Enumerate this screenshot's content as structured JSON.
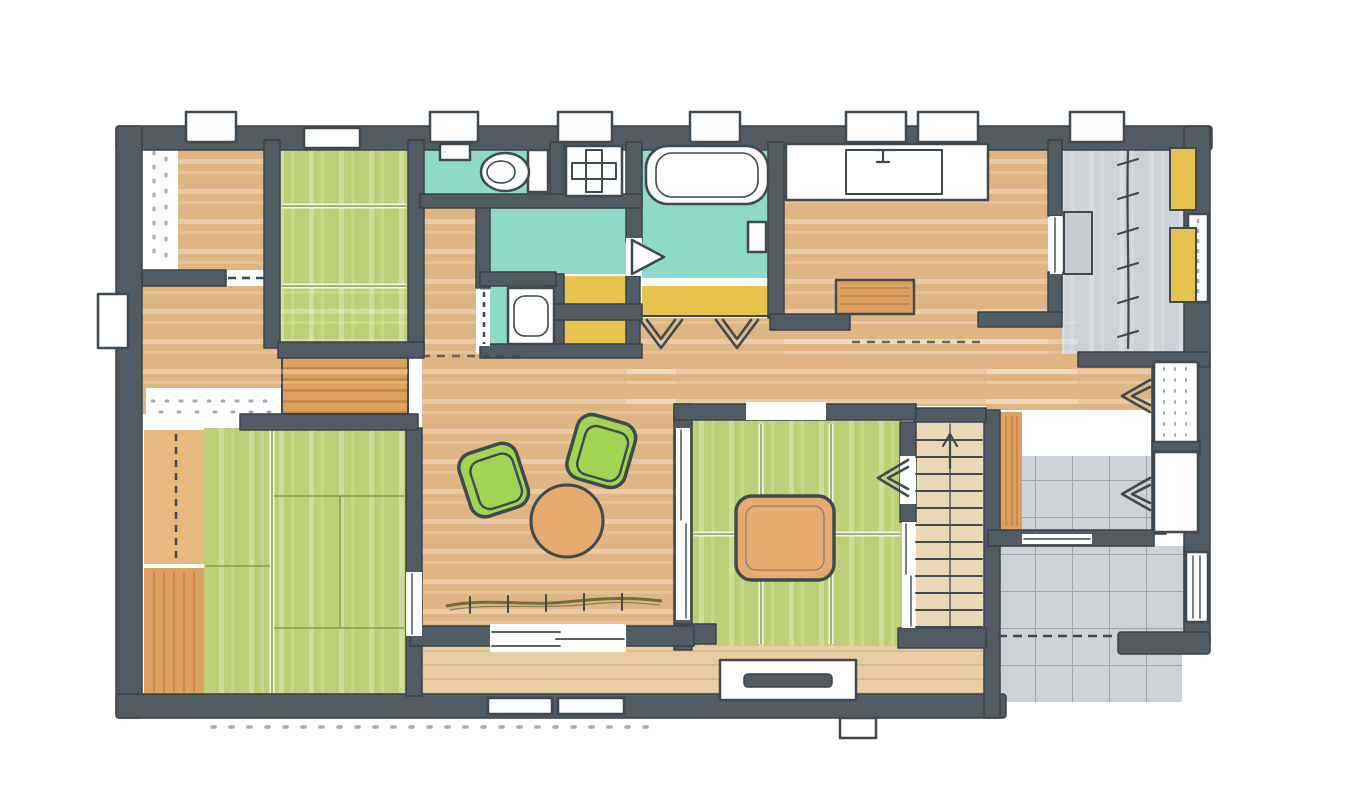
{
  "figure": {
    "label": "Hand-drawn marker sketch floor plan of a single-story Japanese house",
    "medium": "marker and ink sketch on white paper",
    "orientation": "landscape"
  },
  "palette": {
    "paper": "#ffffff",
    "wall": "#505b64",
    "wall_dark": "#39434c",
    "line": "#3e4950",
    "tan": "#dfb584",
    "tan_light": "#e9cda4",
    "wood": "#dda05d",
    "wood_light": "#e7b87e",
    "wood_dark": "#b97f42",
    "green": "#bed077",
    "green_line": "#8a9a50",
    "chair_green": "#a2d353",
    "teal": "#8edac5",
    "yellow": "#e6c24e",
    "tile": "#cdd2d6",
    "tile_line": "#9aa3a9",
    "orange": "#e6a96e",
    "olive": "#6e6f3e",
    "stair_floor": "#ead7b5"
  },
  "rooms": [
    {
      "id": "bedroom-northwest",
      "floor": "tan"
    },
    {
      "id": "bedroom-west",
      "floor": "tan"
    },
    {
      "id": "bedroom-southwest-tatami",
      "floor": "green"
    },
    {
      "id": "bedroom-north-green",
      "floor": "green"
    },
    {
      "id": "toilet-room",
      "floor": "teal"
    },
    {
      "id": "laundry-nook",
      "floor": "white"
    },
    {
      "id": "washroom-vanity",
      "floor": "teal"
    },
    {
      "id": "bathroom",
      "floor": "teal"
    },
    {
      "id": "kitchen",
      "floor": "tan"
    },
    {
      "id": "dining",
      "floor": "tan"
    },
    {
      "id": "living-room",
      "floor": "tan"
    },
    {
      "id": "tatami-room",
      "floor": "green"
    },
    {
      "id": "engawa-veranda",
      "floor": "tan-light"
    },
    {
      "id": "staircase",
      "floor": "stair-floor"
    },
    {
      "id": "east-hallway",
      "floor": "tan"
    },
    {
      "id": "walk-in-storage",
      "floor": "tile"
    },
    {
      "id": "genkan-entry",
      "floor": "tile"
    },
    {
      "id": "entry-porch",
      "floor": "tile"
    },
    {
      "id": "storage-closets-yellow",
      "floor": "yellow"
    }
  ],
  "fixtures": [
    "toilet",
    "hand-basin",
    "washing-machine-pan",
    "bathtub",
    "bath-seat",
    "vanity-sink",
    "kitchen-counter",
    "kitchen-sink",
    "kitchen-island",
    "armchair",
    "armchair",
    "round-table",
    "kotatsu-table",
    "tv-board",
    "stair-treads",
    "up-arrow",
    "hanger-pipe",
    "storage-shelves",
    "entry-bench",
    "step-stone",
    "shoe-closet",
    "wood-deck-slats"
  ],
  "openings": {
    "top_window_boxes": 8,
    "left_window_boxes": 1,
    "bottom_flush_windows": 2,
    "front_door": 1,
    "louver_vent": 1,
    "bifold_door_chevrons": 5,
    "sliding_doors": 7
  }
}
